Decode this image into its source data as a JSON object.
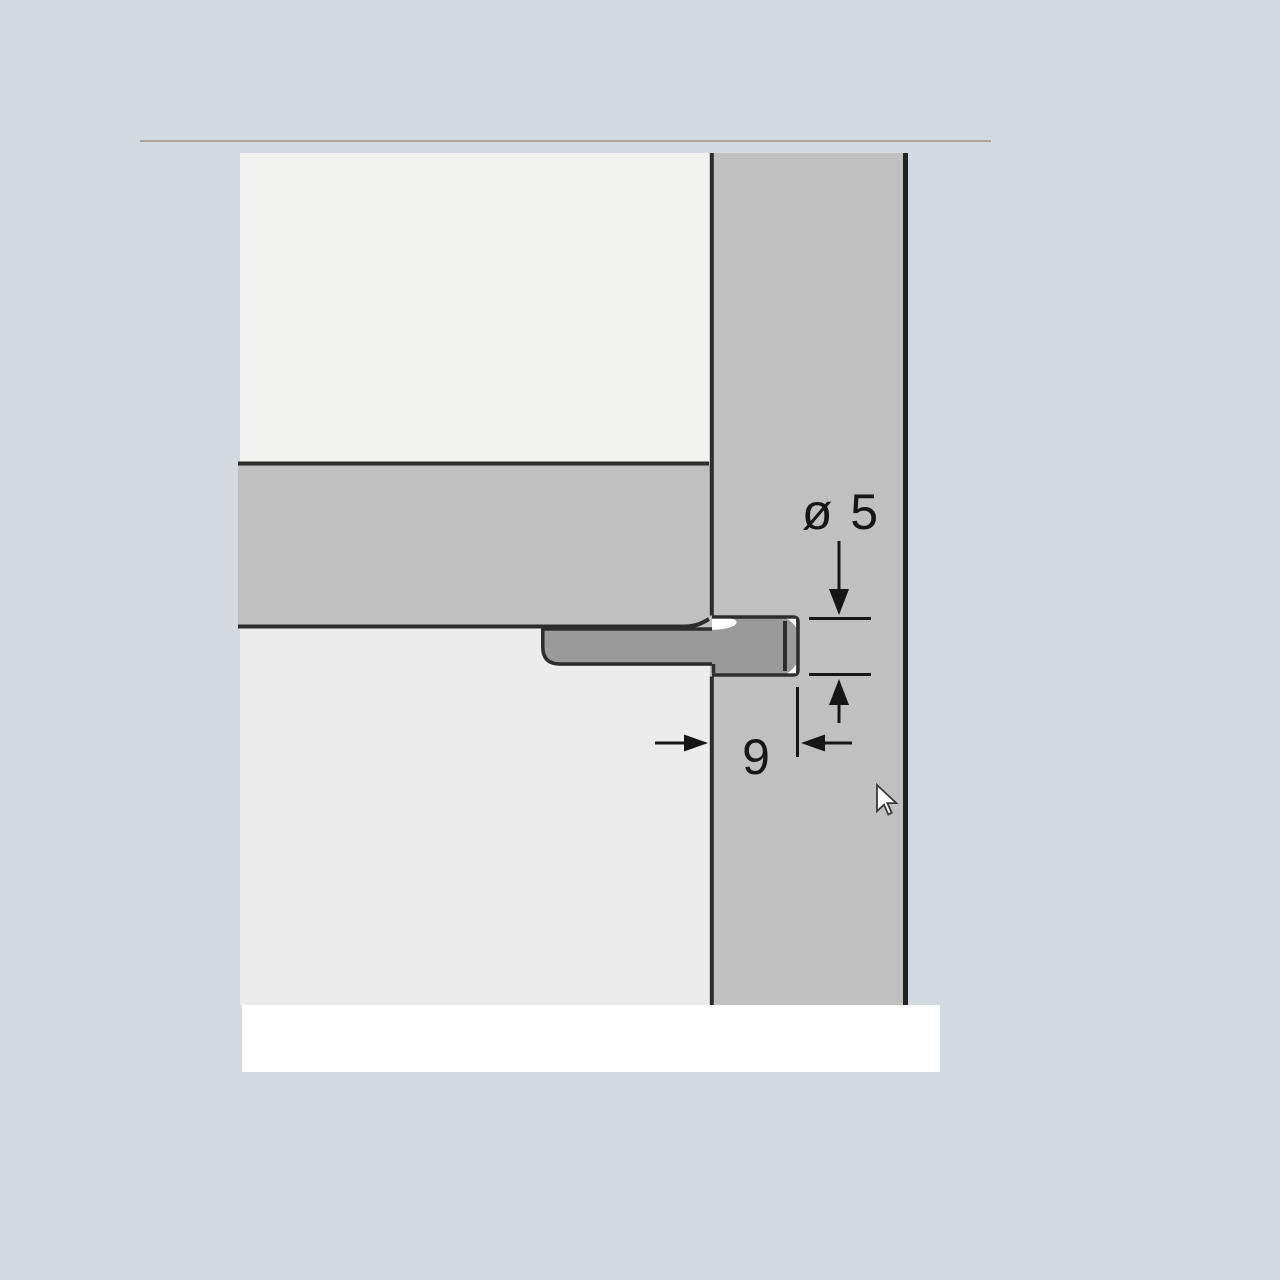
{
  "page": {
    "background_color": "#d4d9e0",
    "top_rule_color": "#aba39d"
  },
  "diagram": {
    "labels": {
      "bore_diameter": "ø 5",
      "bore_depth": "9"
    },
    "colors": {
      "top_panel": "#f1f1ef",
      "bottom_panel": "#ececec",
      "cross_section_band": "#c0c0c0",
      "side_panel": "#c0c0c0",
      "dowel": "#9a9a9a",
      "outline": "#2d2d2d",
      "dimension_ink": "#161616",
      "bore_clearance": "#fdfdfd",
      "base_strip": "#ffffff"
    }
  },
  "cursor": {
    "icon": "arrow-pointer"
  }
}
